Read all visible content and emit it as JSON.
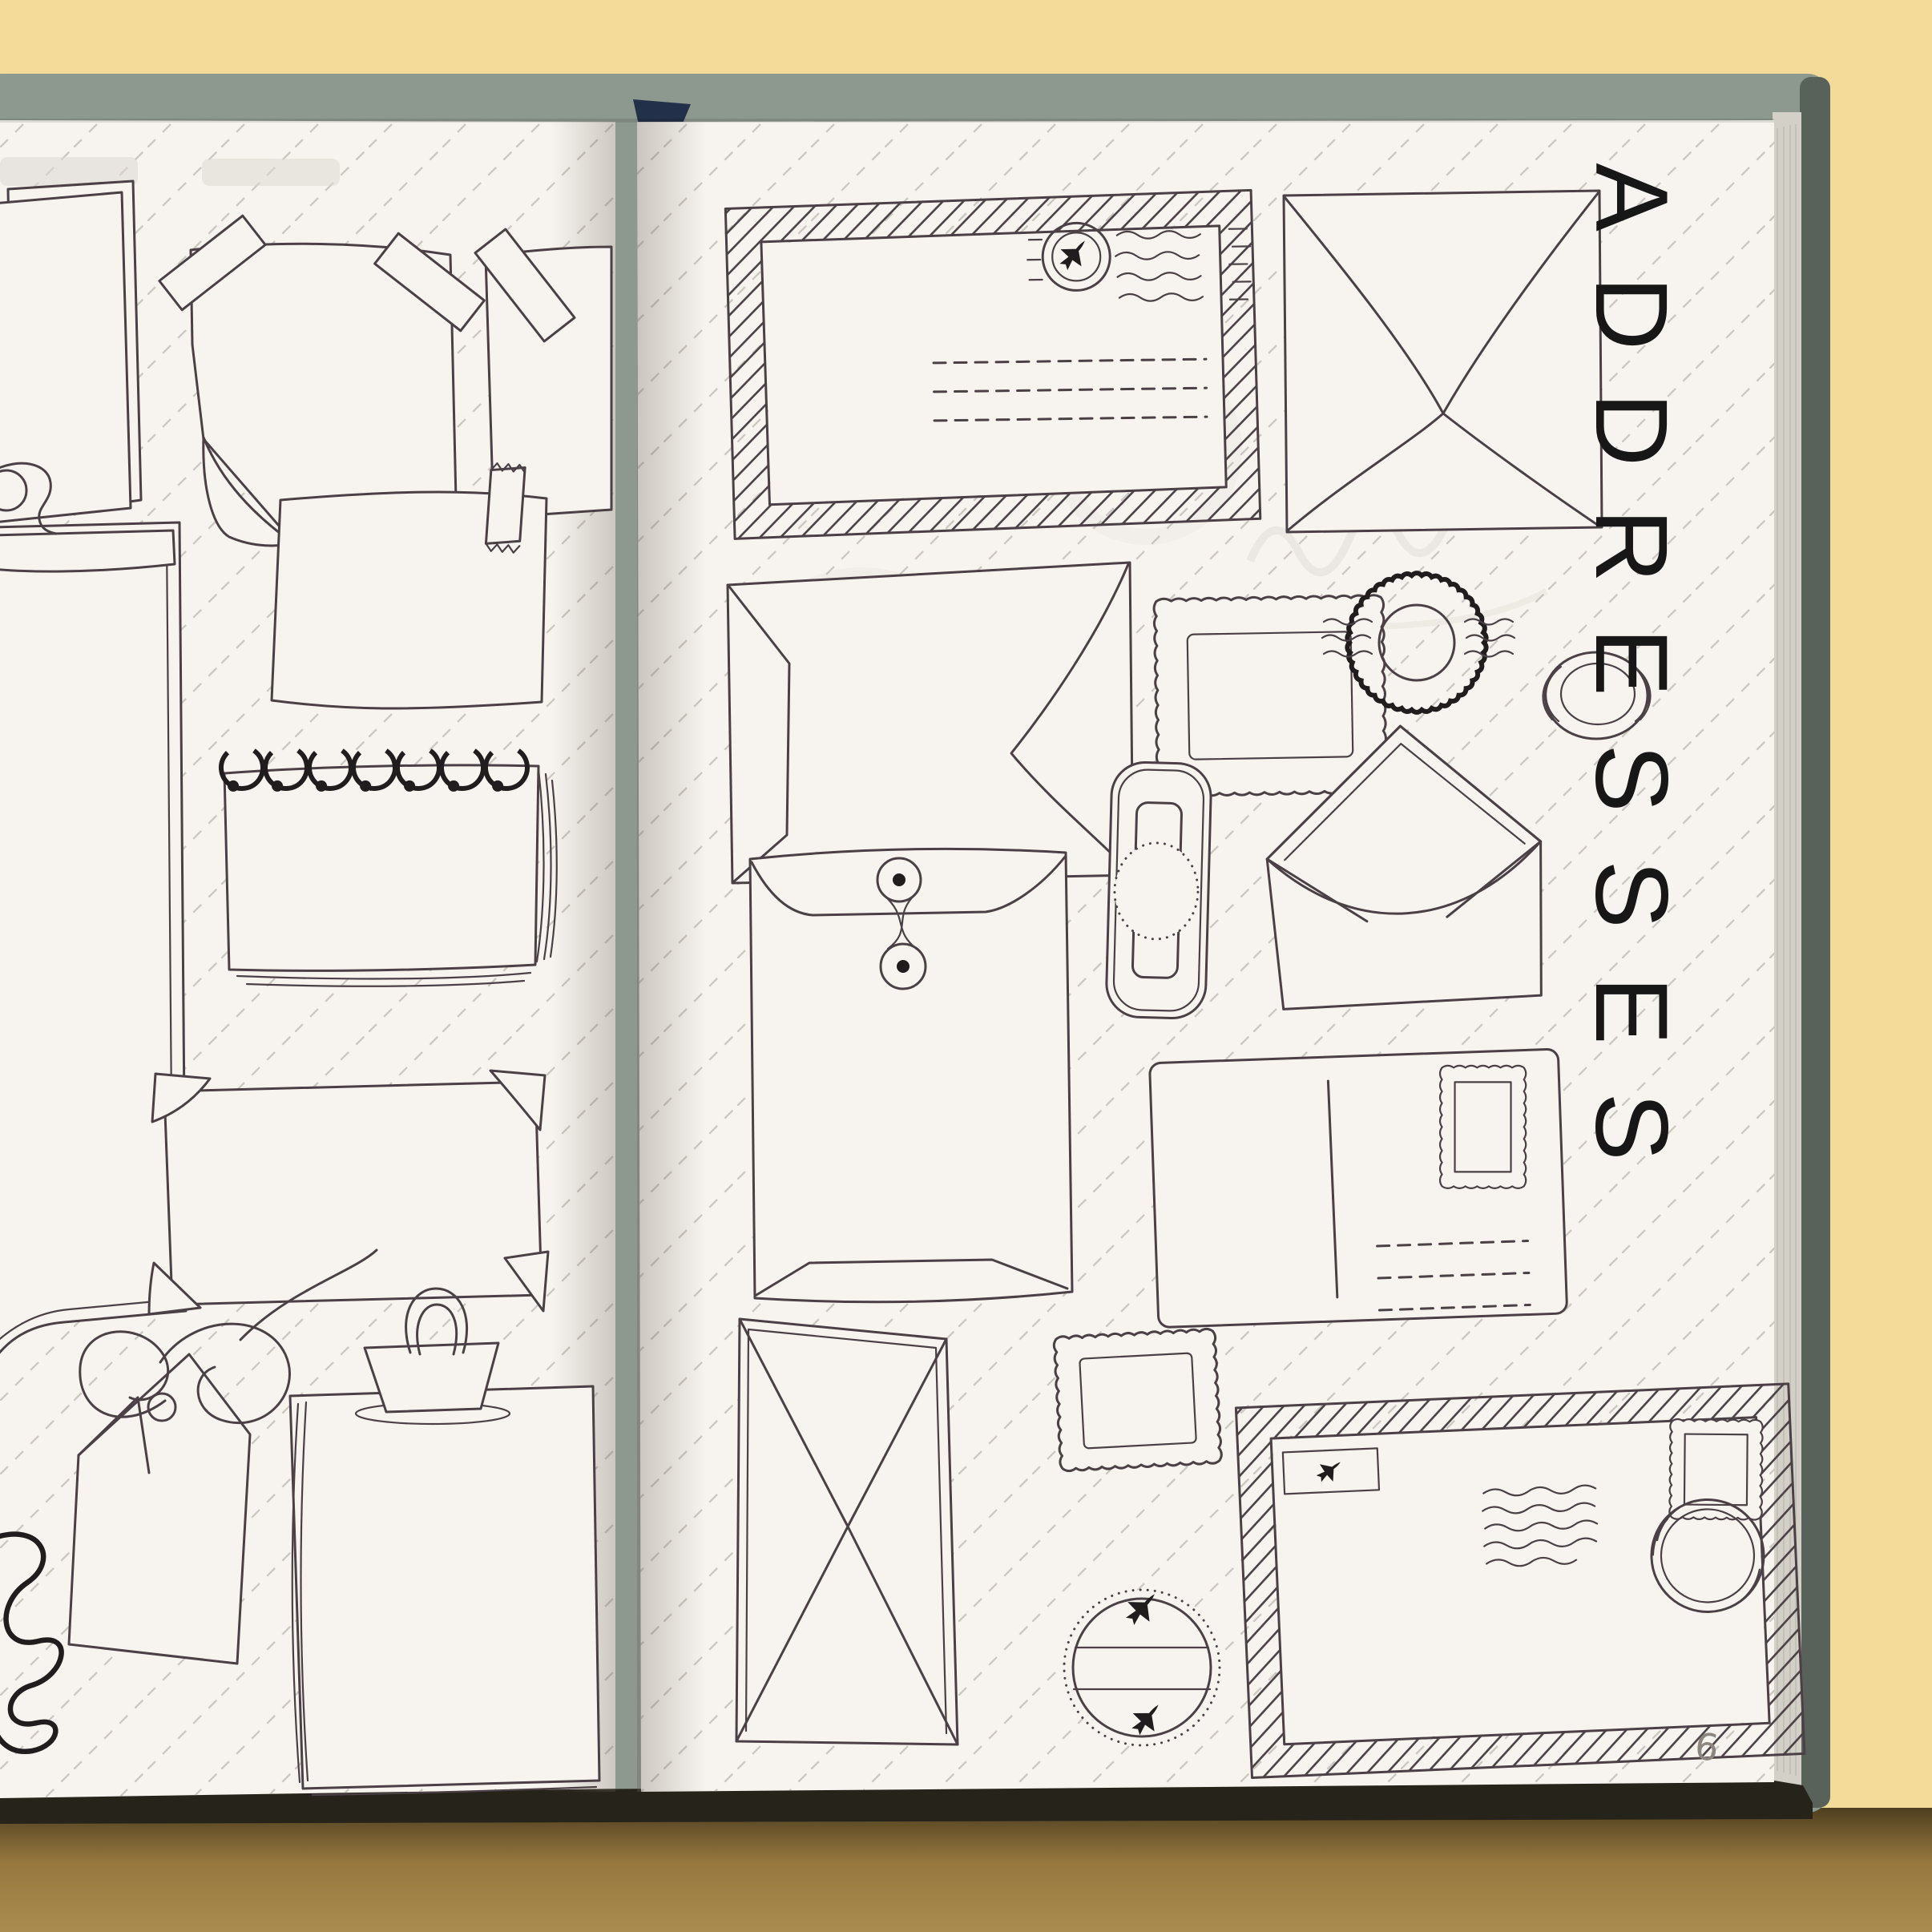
{
  "book": {
    "kind": "open hardcover journal photographed on a yellow surface",
    "right_page": {
      "title": "ADDRESSES",
      "title_orientation": "vertical, letters rotated 90deg clockwise",
      "page_number": "6",
      "illustrations": [
        "airmail-envelope-hatched-border",
        "circular-postmark-airplane",
        "wavy-cancellation-lines",
        "address-dashed-lines",
        "sealed-envelope-back",
        "envelope-back-side-flaps",
        "postage-stamp-blank-large",
        "scalloped-black-postmark",
        "oval-postmark",
        "open-envelope-with-liner",
        "string-tie-closure-envelope",
        "seal-tag-rounded",
        "postcard-with-stamp",
        "postage-stamp-blank-small",
        "envelope-back-diamond-flap",
        "airplane-circle-stamp",
        "airmail-envelope-with-stamp-and-postmark"
      ],
      "counts": {
        "airmail_envelope_dashed_lines": 3,
        "postcard_dashed_lines": 3,
        "airplane_circle_stamp_planes": 2
      }
    },
    "left_page": {
      "illustrations": [
        "stacked-paper-sheets",
        "taped-note-curled-corner",
        "taped-note-partial",
        "clipboard",
        "washi-taped-note",
        "spiral-notepad",
        "photo-corner-frame",
        "gift-tag-with-string",
        "corner-scribble-spring",
        "binder-clip-paper-pad"
      ],
      "counts": {
        "spiral_rings": 7,
        "photo_corners": 4
      }
    },
    "page_style": {
      "pinstripes": "diagonal dashed pinstripes",
      "pinstripe_spacing_px": 92
    },
    "colors": {
      "background_top": "#f5db9a",
      "background_shadow_below_book": "#a8894e",
      "cover_cloth": "#8d988e",
      "cover_fore_edge": "#59625a",
      "page_stack_edge": "#d3d0c8",
      "page": "#f7f4ef",
      "ink_outline": "#4a4046",
      "ink_black_accent": "#211d1f",
      "pinstripe": "#b7b1ab",
      "page_number_grey": "#8c867f",
      "bookmark_navy": "#233049"
    }
  }
}
